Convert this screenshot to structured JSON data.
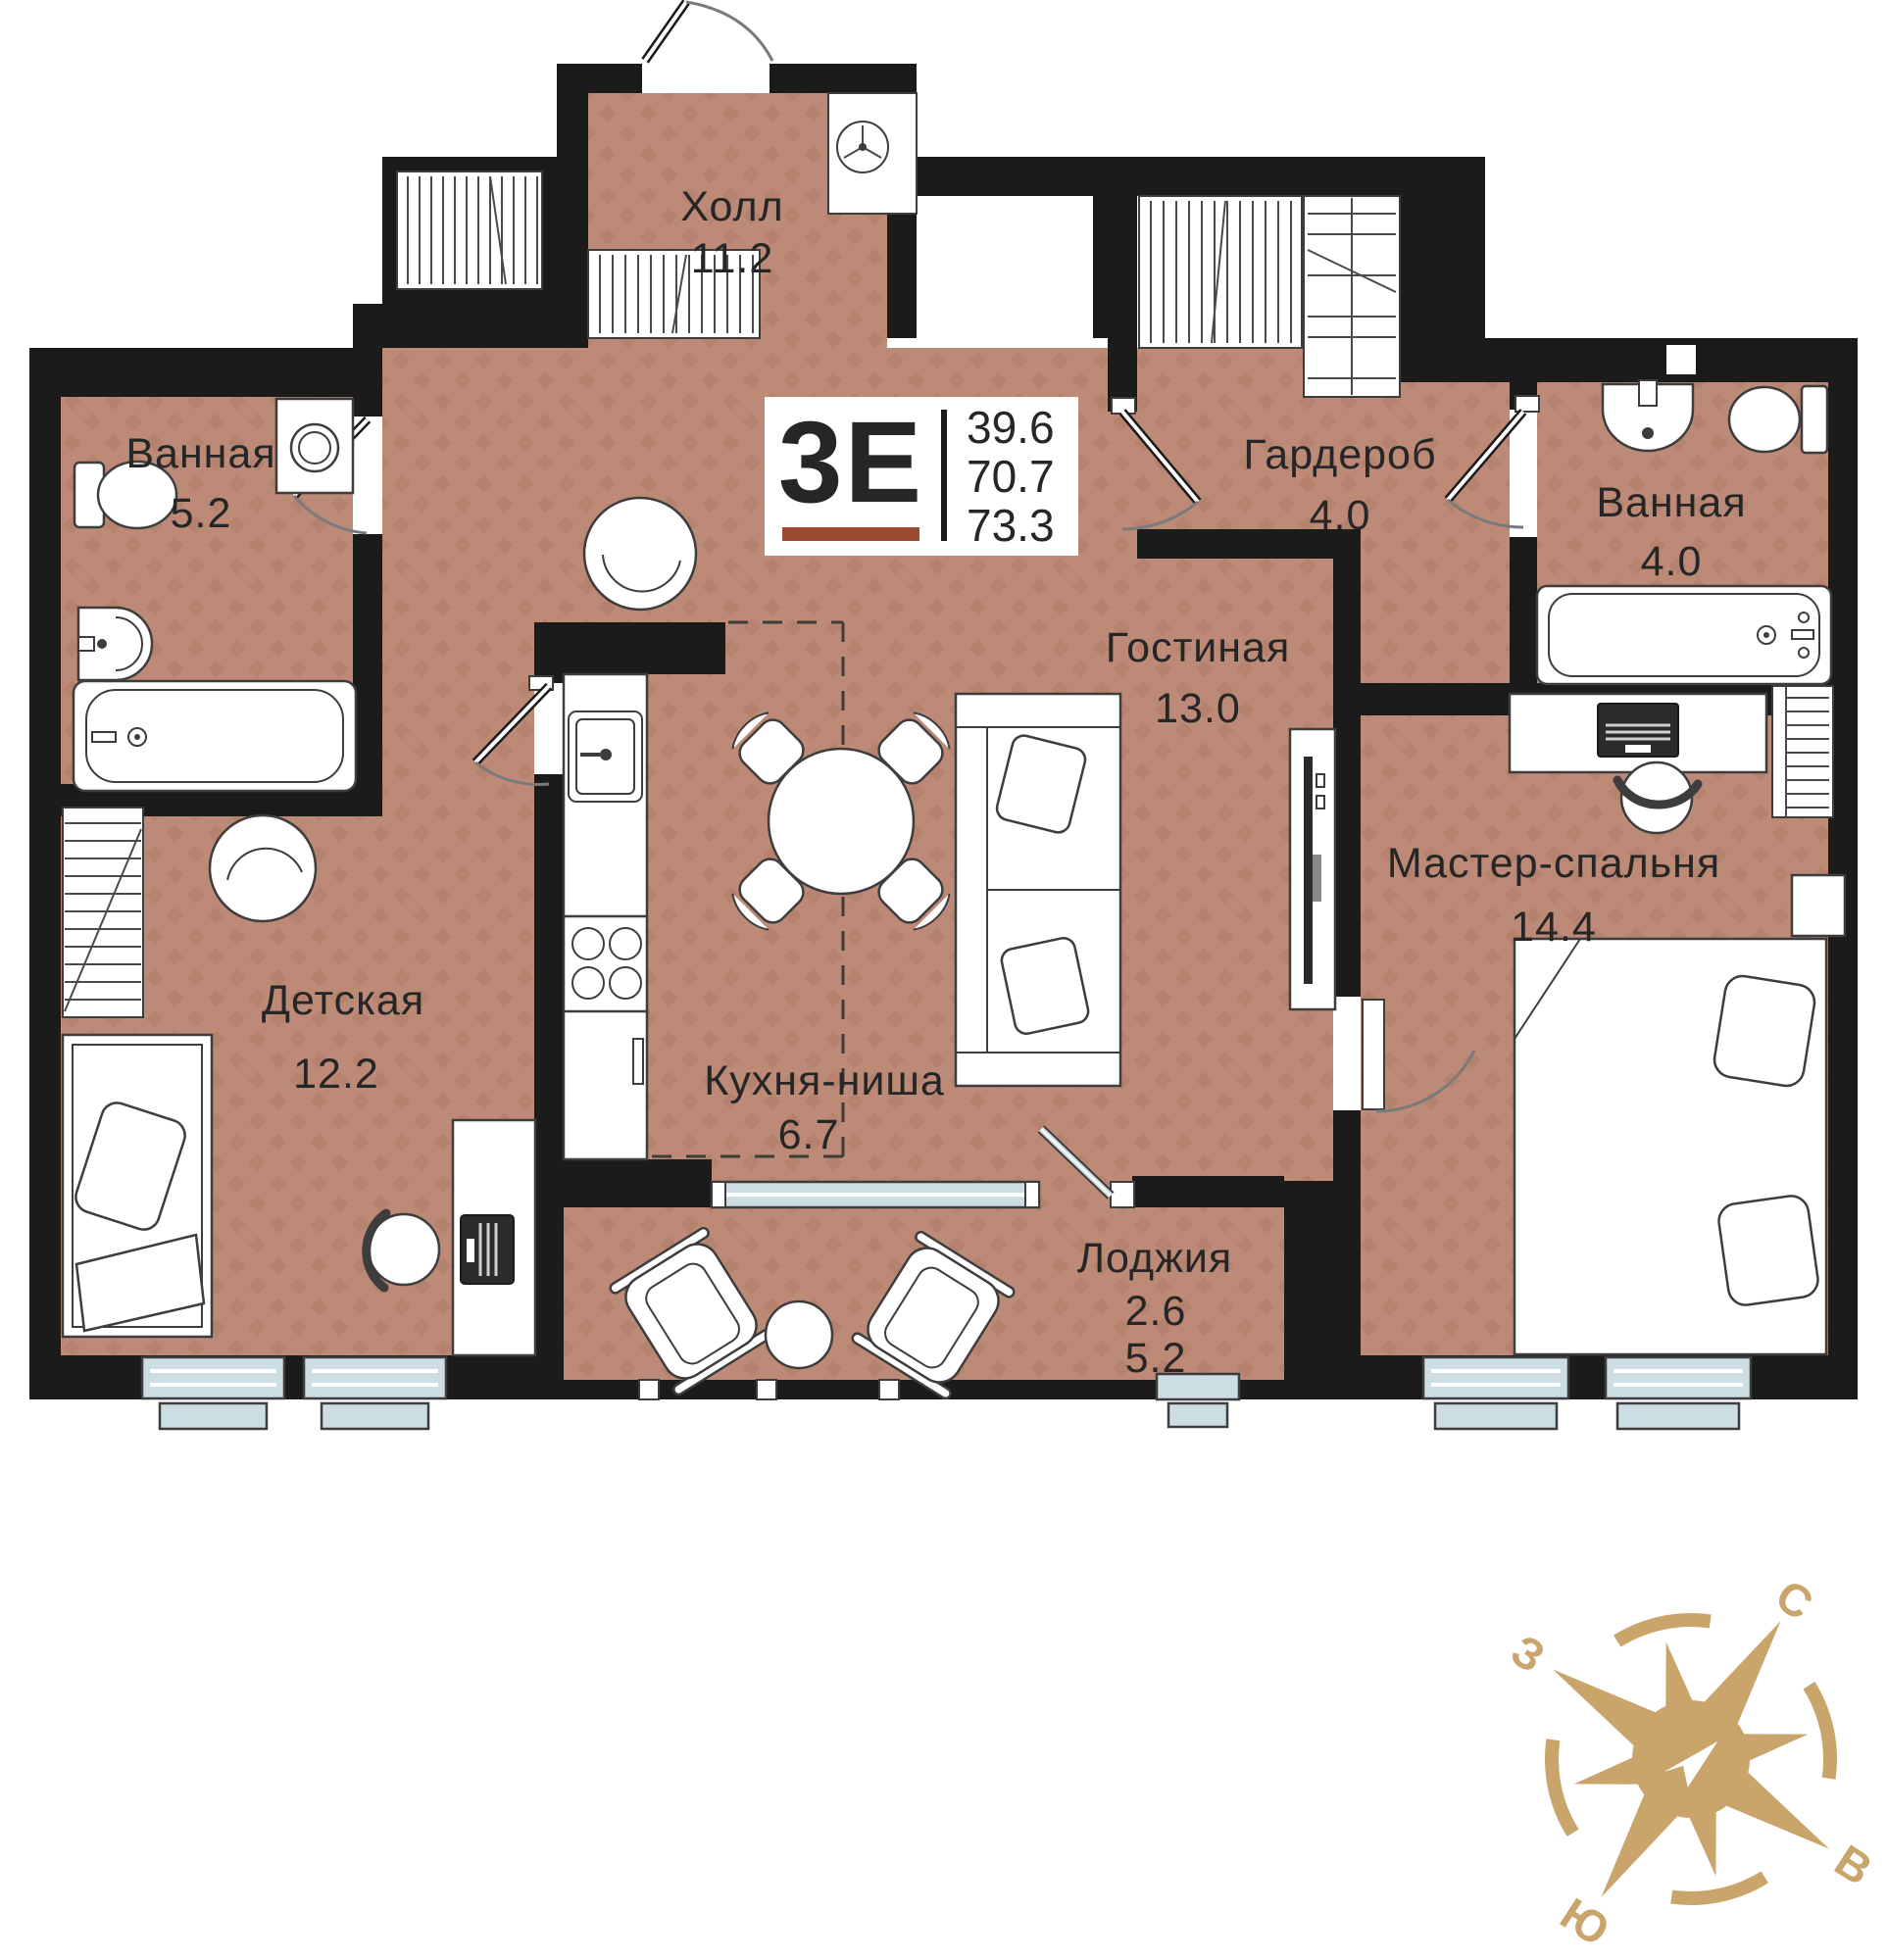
{
  "plan": {
    "unit": {
      "type": "3Е",
      "area_living": "39.6",
      "area_main": "70.7",
      "area_total": "73.3"
    },
    "rooms": [
      {
        "key": "hall",
        "name": "Холл",
        "area": "11.2"
      },
      {
        "key": "bathroom-left",
        "name": "Ванная",
        "area": "5.2"
      },
      {
        "key": "wardrobe",
        "name": "Гардероб",
        "area": "4.0"
      },
      {
        "key": "bathroom-right",
        "name": "Ванная",
        "area": "4.0"
      },
      {
        "key": "living-room",
        "name": "Гостиная",
        "area": "13.0"
      },
      {
        "key": "master-bedroom",
        "name": "Мастер-спальня",
        "area": "14.4"
      },
      {
        "key": "kids-room",
        "name": "Детская",
        "area": "12.2"
      },
      {
        "key": "kitchen-niche",
        "name": "Кухня-ниша",
        "area": "6.7"
      },
      {
        "key": "loggia",
        "name": "Лоджия",
        "area": "2.6",
        "area_total": "5.2"
      }
    ],
    "compass": {
      "north": "С",
      "east": "В",
      "south": "Ю",
      "west": "З"
    },
    "colors": {
      "floor": "#bc8a77",
      "floor_accent": "#b27e6a",
      "wall": "#1b1b1b",
      "window": "#ccdde3",
      "accent": "#9c4a30",
      "gold": "#c9a46b"
    }
  }
}
